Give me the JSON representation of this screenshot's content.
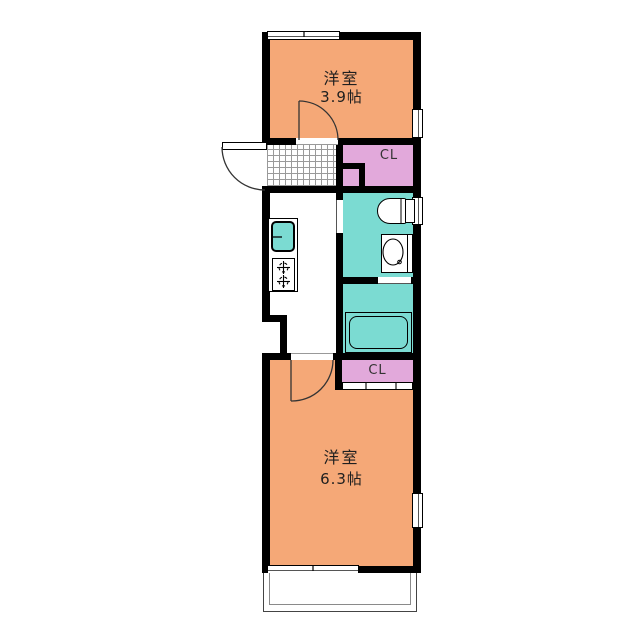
{
  "plan_type": "apartment-floor-plan",
  "rooms": {
    "top_room": {
      "name": "洋室",
      "size": "3.9帖"
    },
    "bottom_room": {
      "name": "洋室",
      "size": "6.3帖"
    },
    "top_closet": {
      "label": "CL"
    },
    "bottom_closet": {
      "label": "CL"
    }
  },
  "fixtures": [
    "entrance-door",
    "genkan-tile",
    "kitchen-sink",
    "gas-stove",
    "toilet",
    "washbasin",
    "bathtub",
    "balcony",
    "windows",
    "room-doors",
    "closet-sliding-door"
  ],
  "colors": {
    "room_fill": "#F5A877",
    "wet_area_fill": "#7BDBD2",
    "closet_fill": "#E2A9DB",
    "wall": "#000000",
    "background": "#FFFFFF"
  }
}
